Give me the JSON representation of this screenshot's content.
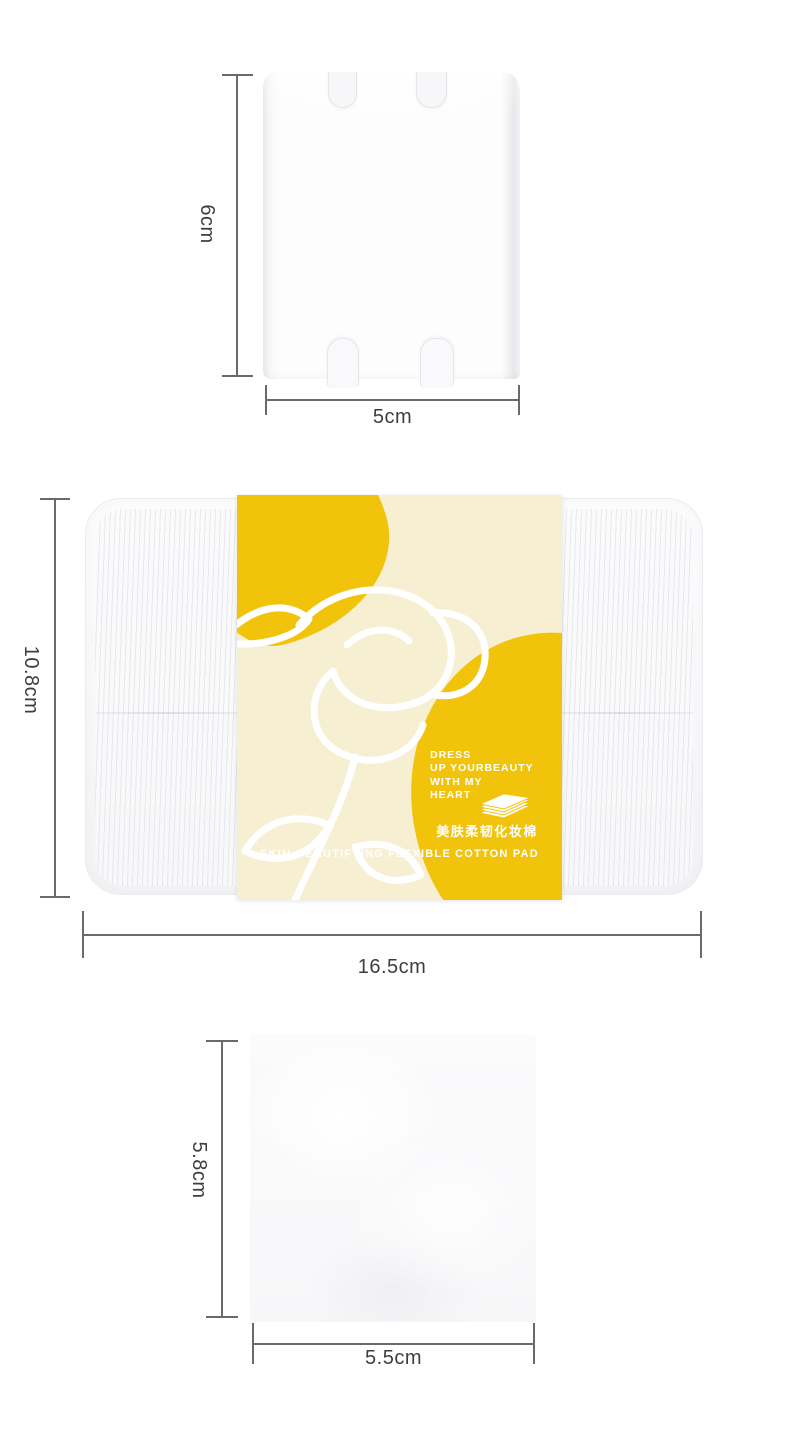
{
  "page": {
    "type": "product-dimension-illustration",
    "background": "#ffffff"
  },
  "colors": {
    "accent_yellow": "#F2C30B",
    "label_cream": "#F6EFD2",
    "dim_line": "#6A6A6A",
    "dim_text": "#3E3E3E"
  },
  "top_section": {
    "item": "single cotton pad",
    "height_dim": "6cm",
    "width_dim": "5cm"
  },
  "middle_section": {
    "item": "cotton pad box with sleeve",
    "height_dim": "10.8cm",
    "width_dim": "16.5cm",
    "label": {
      "tagline": [
        "DRESS",
        "UP YOURBEAUTY",
        "WITH MY",
        "HEART"
      ],
      "product_name_cn": "美肤柔韧化妆棉",
      "product_name_en": "SKIN-BEAUTIFYING FLEXIBLE COTTON PAD",
      "icon": "cotton-pad-stack-icon"
    }
  },
  "bottom_section": {
    "item": "square cotton pad",
    "height_dim": "5.8cm",
    "width_dim": "5.5cm"
  }
}
